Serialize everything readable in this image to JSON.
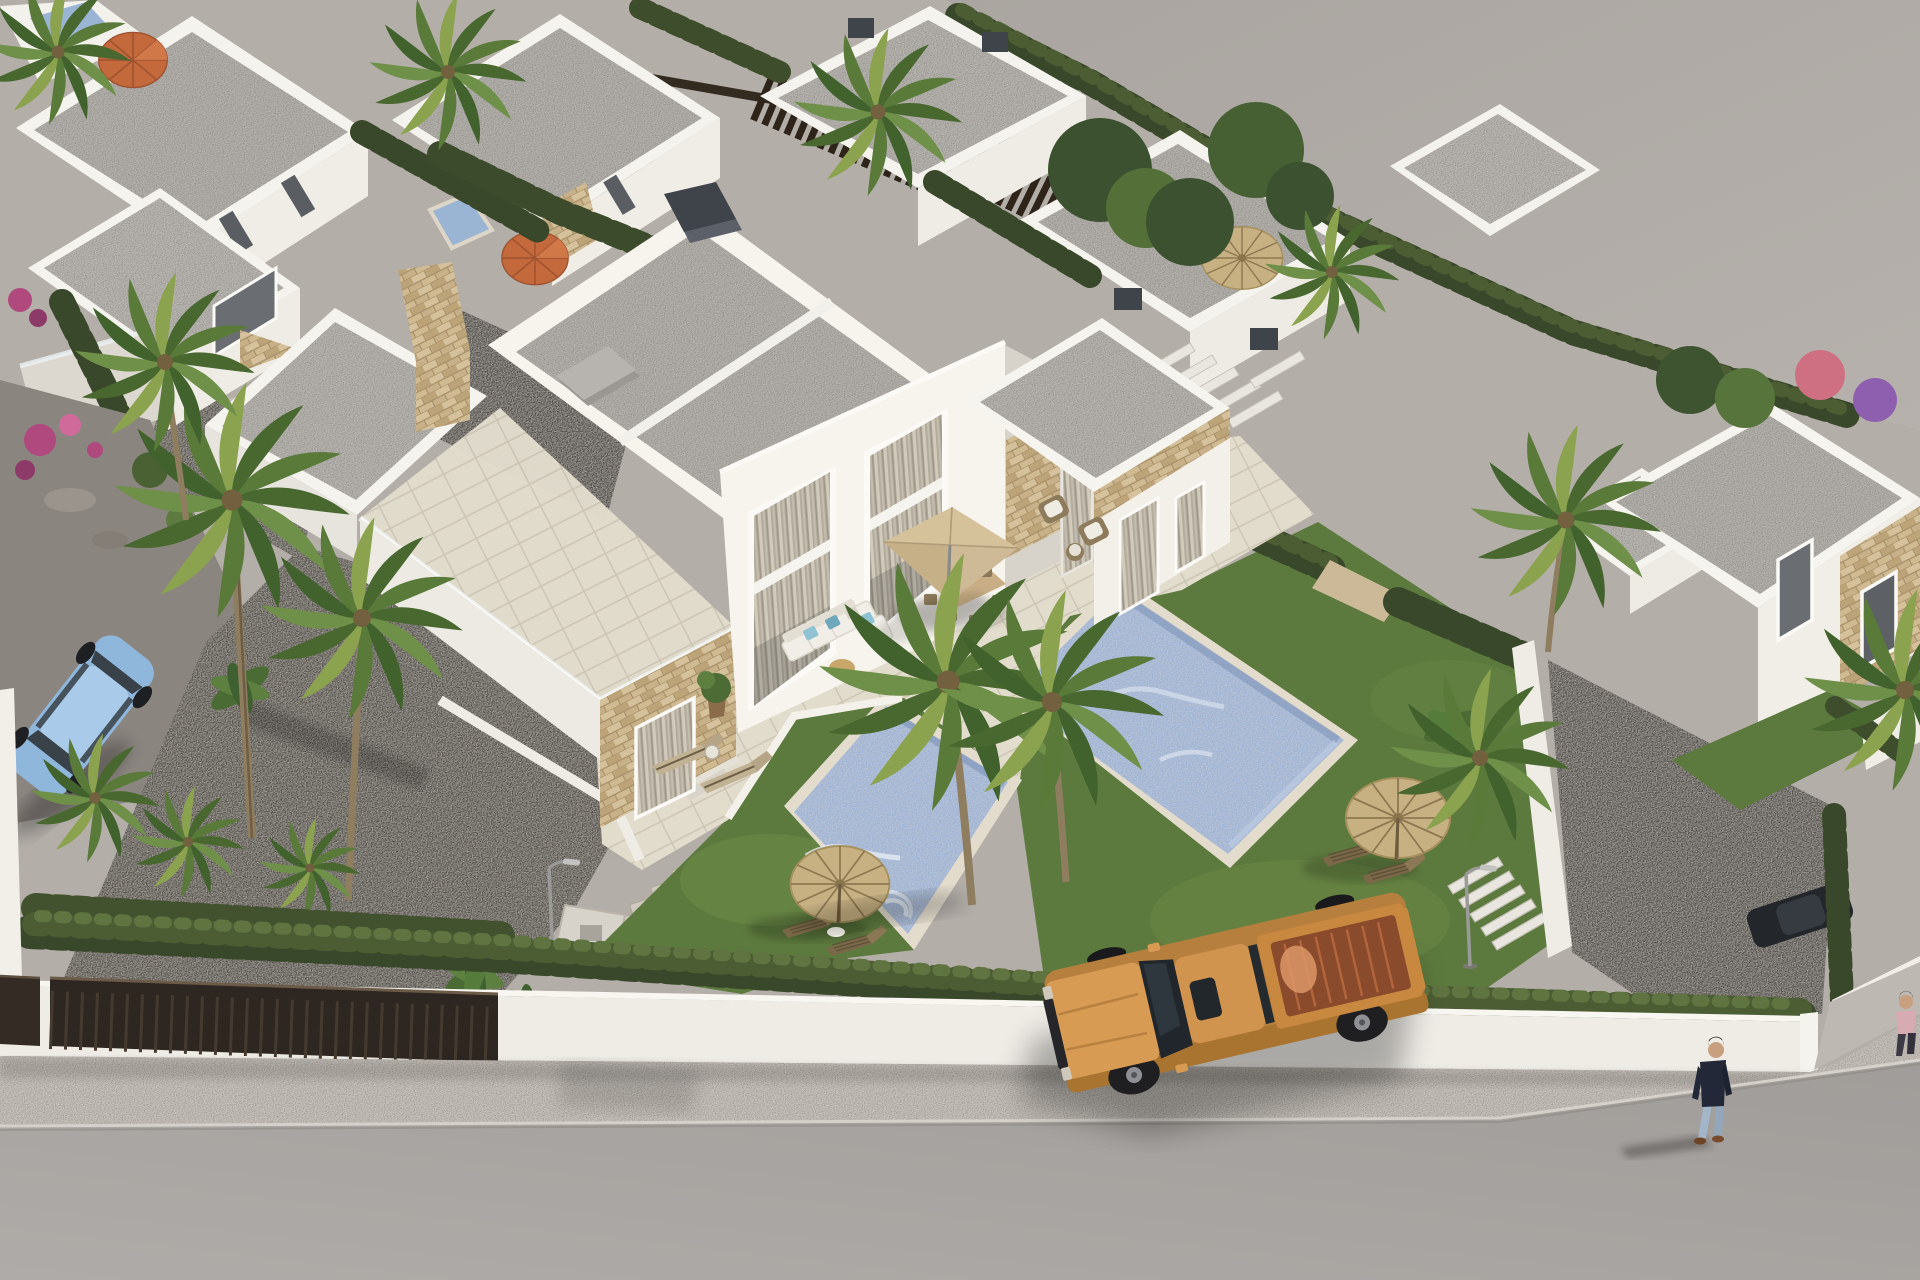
{
  "scene": {
    "type": "aerial-3d-architectural-render",
    "subject": "modern white semi-detached villas with private pools, gardens and street",
    "lighting": "afternoon sun from upper right, long soft shadows to lower left",
    "elements": [
      "central two-storey semi-detached villa with flat granular grey roof and stone-clad accents",
      "two private mosaic-blue swimming pools with pale stone coping",
      "travertine terrace with white L-sofa, blue pillows, tan square parasol and dining set",
      "lawns with thatch straw umbrellas and wooden sun loungers",
      "dark gravel driveways with stepping stones and street lamps",
      "white perimeter wall with dark brown sliding gates and cypress hedges",
      "rows of background villas, roof terraces, orange parasols, red parked car",
      "right-hand neighbouring villas with stone cladding",
      "palm trees, banana plants, magenta and purple flowering shrubs",
      "empty grey plot at upper right",
      "speckled sidewalk and smooth asphalt street",
      "tan pickup truck with open copper bed driving on street",
      "pedestrian in dark top and jeans walking on sidewalk",
      "partial pedestrian in pink at right edge",
      "light-blue saloon car parked inside the left driveway"
    ]
  },
  "counts": {
    "villas_visible": 11,
    "pools_visible": 4,
    "palm_trees": 15,
    "thatch_umbrellas": 3,
    "orange_umbrellas": 2,
    "vehicles": 4,
    "people": 2,
    "street_lamps": 2,
    "gates": 2
  },
  "palette": {
    "road": "#a8a4a1",
    "sidewalk": "#c7c2bb",
    "curb": "#d5d1ca",
    "wall_white": "#efece6",
    "wall_top": "#f8f6f1",
    "gate_brown": "#2e2721",
    "gravel": "#524f4a",
    "hedge_dark": "#39482a",
    "hedge_mid": "#4c5d33",
    "hedge_light": "#5f7440",
    "lawn": "#5d7a3e",
    "lawn_light": "#73904a",
    "pool_water": "#9cb3d6",
    "pool_deep": "#7d93b8",
    "pool_coping": "#e3dccd",
    "roof_gray": "#b5b2ad",
    "villa_white": "#f7f4ee",
    "villa_shade": "#e7e4dd",
    "villa_dark": "#d8d3ca",
    "stone_tan": "#c8b189",
    "terrace_tile": "#e0dacb",
    "terrace_shade": "#cfc8b9",
    "parasol_tan": "#d5c29a",
    "thatch_straw": "#c7b183",
    "wicker": "#8d7b5c",
    "cushion_white": "#f1eee7",
    "pillow_blue": "#8fc2d3",
    "truck_body": "#d79b54",
    "truck_bed": "#8a4a2c",
    "truck_glass": "#20262b",
    "car_blue": "#8fb7dc",
    "car_red": "#7c241f",
    "skin": "#c9a07f",
    "shirt_dark": "#232838",
    "jeans": "#a3b6c9",
    "shirt_pink": "#d8aab2",
    "palm_green": "#5a7a3a",
    "palm_dark": "#41622c",
    "trunk": "#8f7d5f",
    "flower_magenta": "#b0497e",
    "flower_purple": "#8e5fae",
    "umbrella_orange": "#c3693b"
  }
}
